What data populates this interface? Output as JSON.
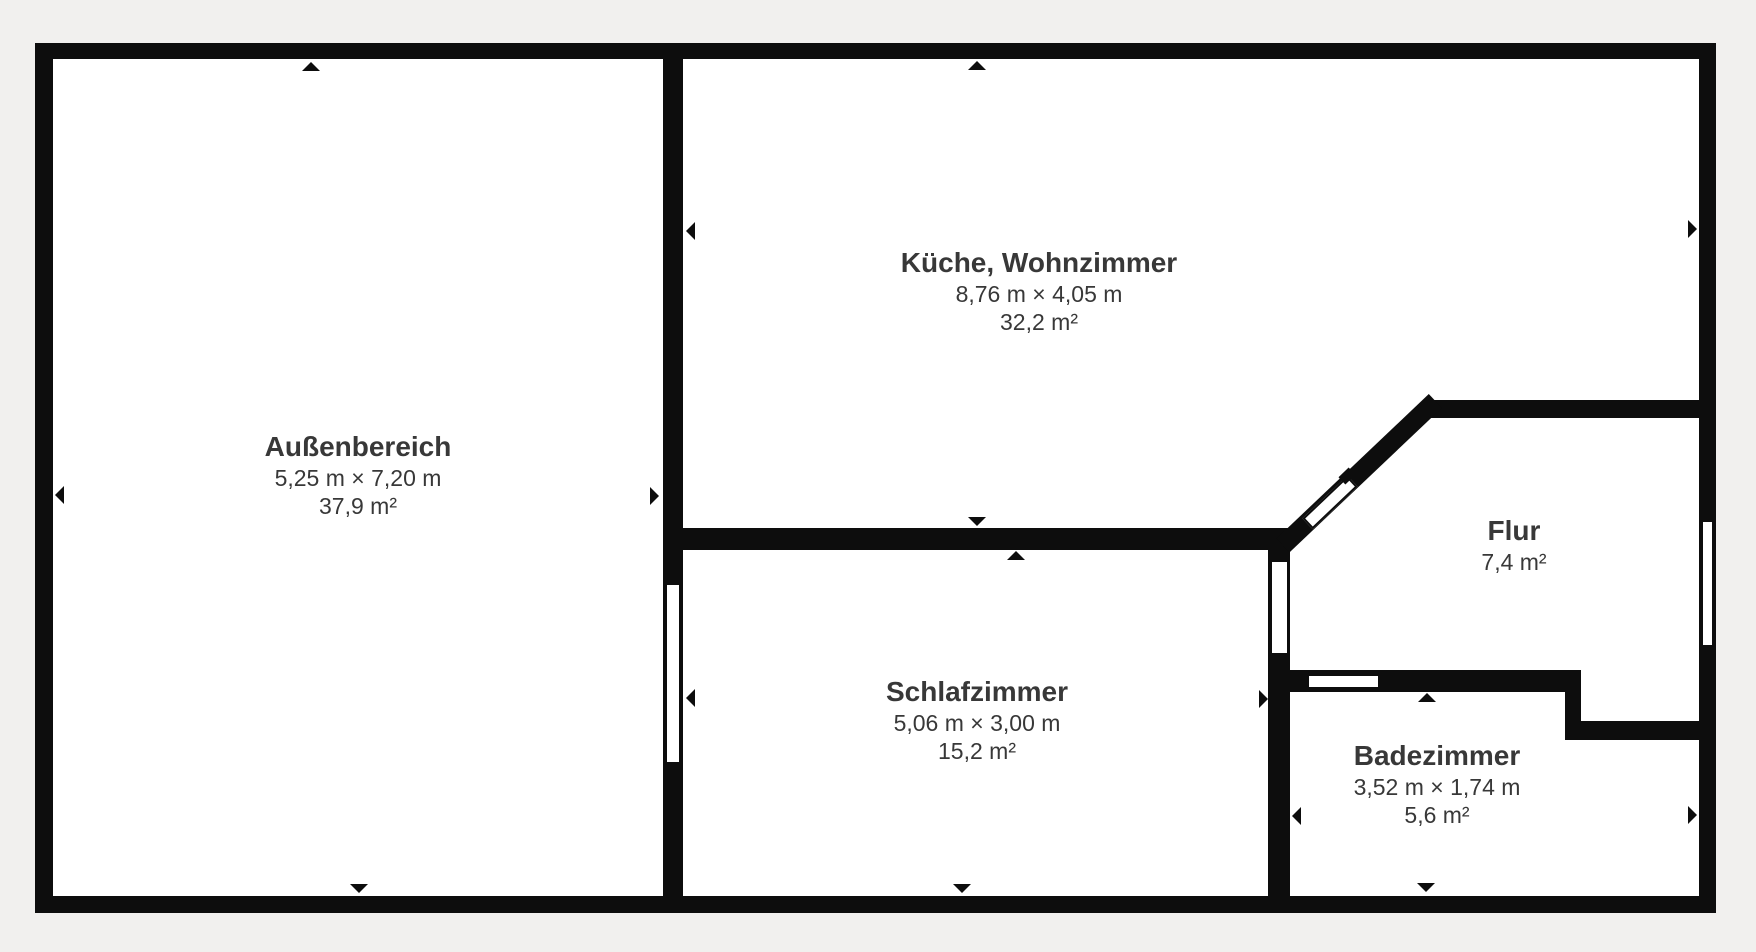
{
  "colors": {
    "background": "#f1f0ee",
    "wall": "#0d0d0d",
    "text": "#383838",
    "room_fill": "#ffffff"
  },
  "rooms": [
    {
      "name": "Außenbereich",
      "dimensions": "5,25 m × 7,20 m",
      "area": "37,9 m²"
    },
    {
      "name": "Küche, Wohnzimmer",
      "dimensions": "8,76 m × 4,05 m",
      "area": "32,2 m²"
    },
    {
      "name": "Schlafzimmer",
      "dimensions": "5,06 m × 3,00 m",
      "area": "15,2 m²"
    },
    {
      "name": "Flur",
      "area": "7,4 m²"
    },
    {
      "name": "Badezimmer",
      "dimensions": "3,52 m × 1,74 m",
      "area": "5,6 m²"
    }
  ]
}
